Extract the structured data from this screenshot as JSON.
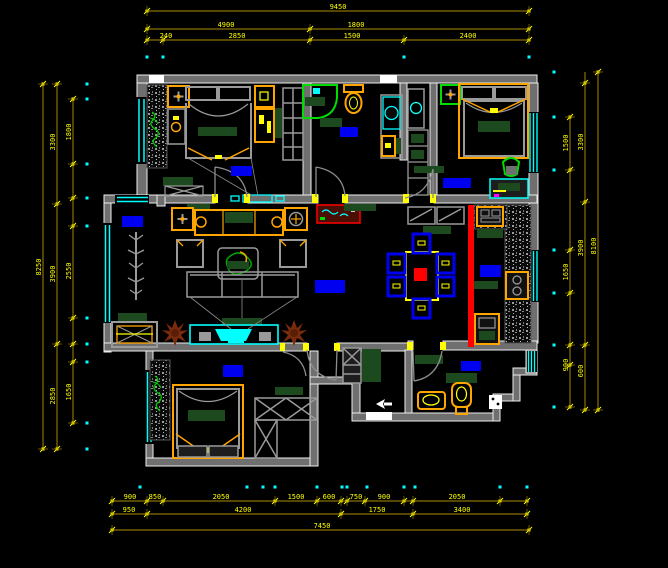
{
  "title": "apartment-floor-plan-cad-drawing",
  "colors": {
    "background": "#000000",
    "wall_fill": "#6f6f6f",
    "wall_edge": "#f0f0f0",
    "window": "#00ffff",
    "dim_line": "#8a7000",
    "dim_text": "#ffff00",
    "dim_marker": "#ffff00",
    "datum_dot": "#00ffff",
    "furniture": "#ffa500",
    "soft_goods": "#1c4a1e",
    "fixture_green": "#00dd00",
    "room_label": "#0000f0",
    "slide_door": "#ff0000",
    "plant": "#7a2b0c"
  },
  "dimensions": {
    "top": {
      "rows": [
        {
          "y": 11,
          "x1": 147,
          "x2": 529,
          "ticks": [
            147,
            529
          ],
          "labels": [
            {
              "x": 338,
              "text": "9450"
            }
          ]
        },
        {
          "y": 29,
          "x1": 147,
          "x2": 529,
          "ticks": [
            147,
            310,
            529
          ],
          "labels": [
            {
              "x": 226,
              "text": "4900"
            },
            {
              "x": 356,
              "text": "1800"
            }
          ]
        },
        {
          "y": 40,
          "x1": 147,
          "x2": 529,
          "ticks": [
            147,
            163,
            310,
            404,
            529
          ],
          "labels": [
            {
              "x": 166,
              "text": "240"
            },
            {
              "x": 237,
              "text": "2850"
            },
            {
              "x": 352,
              "text": "1500"
            },
            {
              "x": 468,
              "text": "2400"
            }
          ]
        }
      ],
      "dots_y": 57,
      "dots": [
        147,
        163,
        404,
        529
      ]
    },
    "bottom": {
      "rows": [
        {
          "y": 501,
          "x1": 112,
          "x2": 527,
          "ticks": [
            112,
            147,
            163,
            275,
            317,
            341,
            347,
            365,
            404,
            413,
            500,
            527
          ],
          "labels": [
            {
              "x": 130,
              "text": "900"
            },
            {
              "x": 155,
              "text": "850"
            },
            {
              "x": 221,
              "text": "2050"
            },
            {
              "x": 296,
              "text": "1500"
            },
            {
              "x": 329,
              "text": "600"
            },
            {
              "x": 356,
              "text": "750"
            },
            {
              "x": 384,
              "text": "900"
            },
            {
              "x": 457,
              "text": "2050"
            }
          ]
        },
        {
          "y": 514,
          "x1": 112,
          "x2": 527,
          "ticks": [
            112,
            147,
            341,
            413,
            527
          ],
          "labels": [
            {
              "x": 129,
              "text": "950"
            },
            {
              "x": 243,
              "text": "4200"
            },
            {
              "x": 377,
              "text": "1750"
            },
            {
              "x": 462,
              "text": "3400"
            }
          ]
        },
        {
          "y": 530,
          "x1": 112,
          "x2": 529,
          "ticks": [
            112,
            529
          ],
          "labels": [
            {
              "x": 322,
              "text": "7450"
            }
          ]
        }
      ],
      "dots_y": 487,
      "dots": [
        140,
        247,
        263,
        275,
        317,
        342,
        347,
        367,
        404,
        415,
        500,
        527
      ]
    },
    "left": {
      "cols": [
        {
          "x": 43,
          "y1": 84,
          "y2": 449,
          "ticks": [
            84,
            449
          ],
          "labels": [
            {
              "y": 267,
              "text": "8250"
            }
          ]
        },
        {
          "x": 57,
          "y1": 84,
          "y2": 449,
          "ticks": [
            84,
            204,
            344,
            449
          ],
          "labels": [
            {
              "y": 142,
              "text": "3300"
            },
            {
              "y": 274,
              "text": "3900"
            },
            {
              "y": 396,
              "text": "2850"
            }
          ]
        },
        {
          "x": 73,
          "y1": 99,
          "y2": 423,
          "ticks": [
            99,
            164,
            198,
            226,
            318,
            344,
            362,
            423
          ],
          "labels": [
            {
              "y": 132,
              "text": "1800"
            },
            {
              "y": 271,
              "text": "2550"
            },
            {
              "y": 392,
              "text": "1650"
            }
          ]
        }
      ],
      "dots_x": 87,
      "dots": [
        84,
        99,
        164,
        198,
        226,
        318,
        344,
        362,
        423,
        449
      ]
    },
    "right": {
      "cols": [
        {
          "x": 598,
          "y1": 72,
          "y2": 410,
          "ticks": [
            72,
            410
          ],
          "labels": [
            {
              "y": 246,
              "text": "8100"
            }
          ]
        },
        {
          "x": 585,
          "y1": 72,
          "y2": 410,
          "ticks": [
            83,
            202,
            345,
            410
          ],
          "labels": [
            {
              "y": 142,
              "text": "3300"
            },
            {
              "y": 248,
              "text": "3900"
            },
            {
              "y": 371,
              "text": "600"
            }
          ]
        },
        {
          "x": 570,
          "y1": 117,
          "y2": 407,
          "ticks": [
            117,
            170,
            250,
            293,
            345,
            365,
            407
          ],
          "labels": [
            {
              "y": 143,
              "text": "1500"
            },
            {
              "y": 272,
              "text": "1650"
            },
            {
              "y": 365,
              "text": "900"
            }
          ]
        }
      ],
      "dots_x": 554,
      "dots": [
        72,
        117,
        170,
        250,
        293,
        345,
        407
      ]
    }
  },
  "room_labels": [
    {
      "id": "balcony",
      "x": 122,
      "y": 216,
      "w": 21,
      "h": 11
    },
    {
      "id": "bedroom-1",
      "x": 231,
      "y": 166,
      "w": 21,
      "h": 10
    },
    {
      "id": "bathroom-1",
      "x": 340,
      "y": 127,
      "w": 18,
      "h": 10
    },
    {
      "id": "bedroom-2",
      "x": 443,
      "y": 178,
      "w": 28,
      "h": 10
    },
    {
      "id": "living-room",
      "x": 315,
      "y": 280,
      "w": 30,
      "h": 13
    },
    {
      "id": "kitchen",
      "x": 480,
      "y": 265,
      "w": 21,
      "h": 12
    },
    {
      "id": "bedroom-3",
      "x": 223,
      "y": 365,
      "w": 20,
      "h": 12
    },
    {
      "id": "bathroom-2",
      "x": 461,
      "y": 361,
      "w": 20,
      "h": 10
    }
  ]
}
